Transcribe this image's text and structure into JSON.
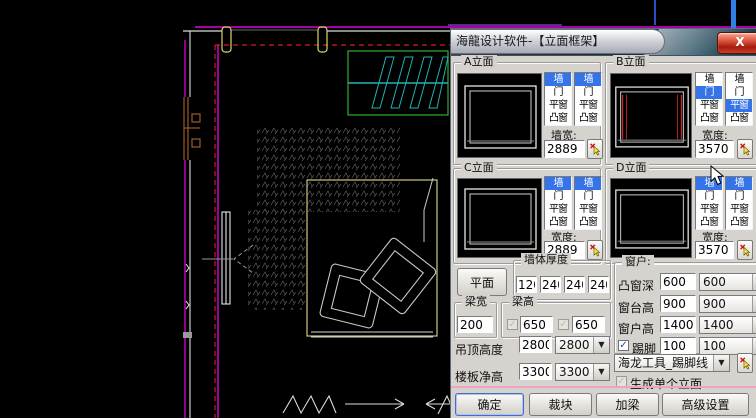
{
  "window": {
    "title": "海龍设计软件-【立面框架】",
    "close": "X"
  },
  "elevations": [
    {
      "label": "A立面",
      "width_label": "墙宽:",
      "width_value": "2889",
      "list1": {
        "items": [
          "墙",
          "门",
          "平窗",
          "凸窗"
        ],
        "selected": 0
      },
      "list2": {
        "items": [
          "墙",
          "门",
          "平窗",
          "凸窗"
        ],
        "selected": 0
      }
    },
    {
      "label": "B立面",
      "width_label": "宽度:",
      "width_value": "3570",
      "list1": {
        "items": [
          "墙",
          "门",
          "平窗",
          "凸窗"
        ],
        "selected": 1
      },
      "list2": {
        "items": [
          "墙",
          "门",
          "平窗",
          "凸窗"
        ],
        "selected": 2
      }
    },
    {
      "label": "C立面",
      "width_label": "宽度:",
      "width_value": "2889",
      "list1": {
        "items": [
          "墙",
          "门",
          "平窗",
          "凸窗"
        ],
        "selected": 0
      },
      "list2": {
        "items": [
          "墙",
          "门",
          "平窗",
          "凸窗"
        ],
        "selected": 0
      }
    },
    {
      "label": "D立面",
      "width_label": "宽度:",
      "width_value": "3570",
      "list1": {
        "items": [
          "墙",
          "门",
          "平窗",
          "凸窗"
        ],
        "selected": 0
      },
      "list2": {
        "items": [
          "墙",
          "门",
          "平窗",
          "凸窗"
        ],
        "selected": 0
      }
    }
  ],
  "plan_button": "平面",
  "wall_thickness": {
    "label": "墙体厚度",
    "values": [
      "120",
      "240",
      "240",
      "240"
    ]
  },
  "beam": {
    "width_label": "梁宽",
    "width_value": "200",
    "height_label": "梁高",
    "height_values": [
      "650",
      "650"
    ]
  },
  "heights": [
    {
      "label": "吊顶高度",
      "value": "2800",
      "combo": "2800"
    },
    {
      "label": "楼板净高",
      "value": "3300",
      "combo": "3300"
    }
  ],
  "window_group": {
    "label": "窗户:",
    "rows": [
      {
        "label": "凸窗深",
        "value": "600",
        "combo": "600"
      },
      {
        "label": "窗台高",
        "value": "900",
        "combo": "900"
      },
      {
        "label": "窗户高",
        "value": "1400",
        "combo": "1400"
      }
    ],
    "skirting": {
      "label": "踢脚",
      "value": "100",
      "combo": "100",
      "checked": true
    },
    "tool_combo": "海龙工具_踢脚线",
    "single_label": "生成单个立面"
  },
  "footer_buttons": [
    "确定",
    "裁块",
    "加梁",
    "高级设置"
  ],
  "colors": {
    "dialog_bg": "#d6d3ce",
    "selection_blue": "#3473e8",
    "separator_pink": "#f0a2c2",
    "close_red": "#b6301f",
    "preview_red": "#b42828",
    "cad_magenta": "#dd00dd",
    "cad_yellow": "#d8d868",
    "cad_cyan": "#22b2b2",
    "cad_green": "#2fae2f",
    "cad_red": "#b61818",
    "cad_brown": "#a05a28",
    "cad_white": "#dcdcdc",
    "cad_gray": "#8a8a8a"
  }
}
